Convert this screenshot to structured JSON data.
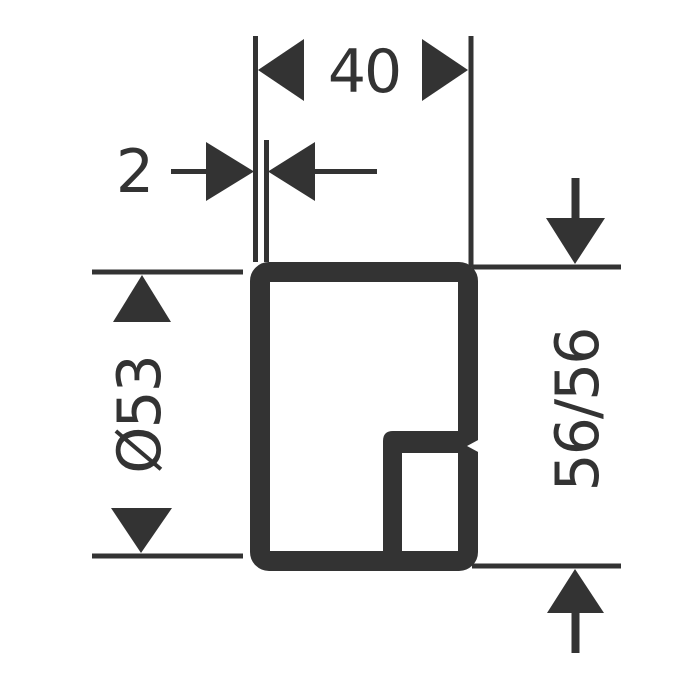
{
  "drawing": {
    "type": "technical-dimension-drawing",
    "colors": {
      "ink": "#333333",
      "background": "#ffffff"
    },
    "labels": {
      "width_top": "40",
      "wall_offset": "2",
      "diameter": "Ø53",
      "depth": "56/56"
    }
  }
}
